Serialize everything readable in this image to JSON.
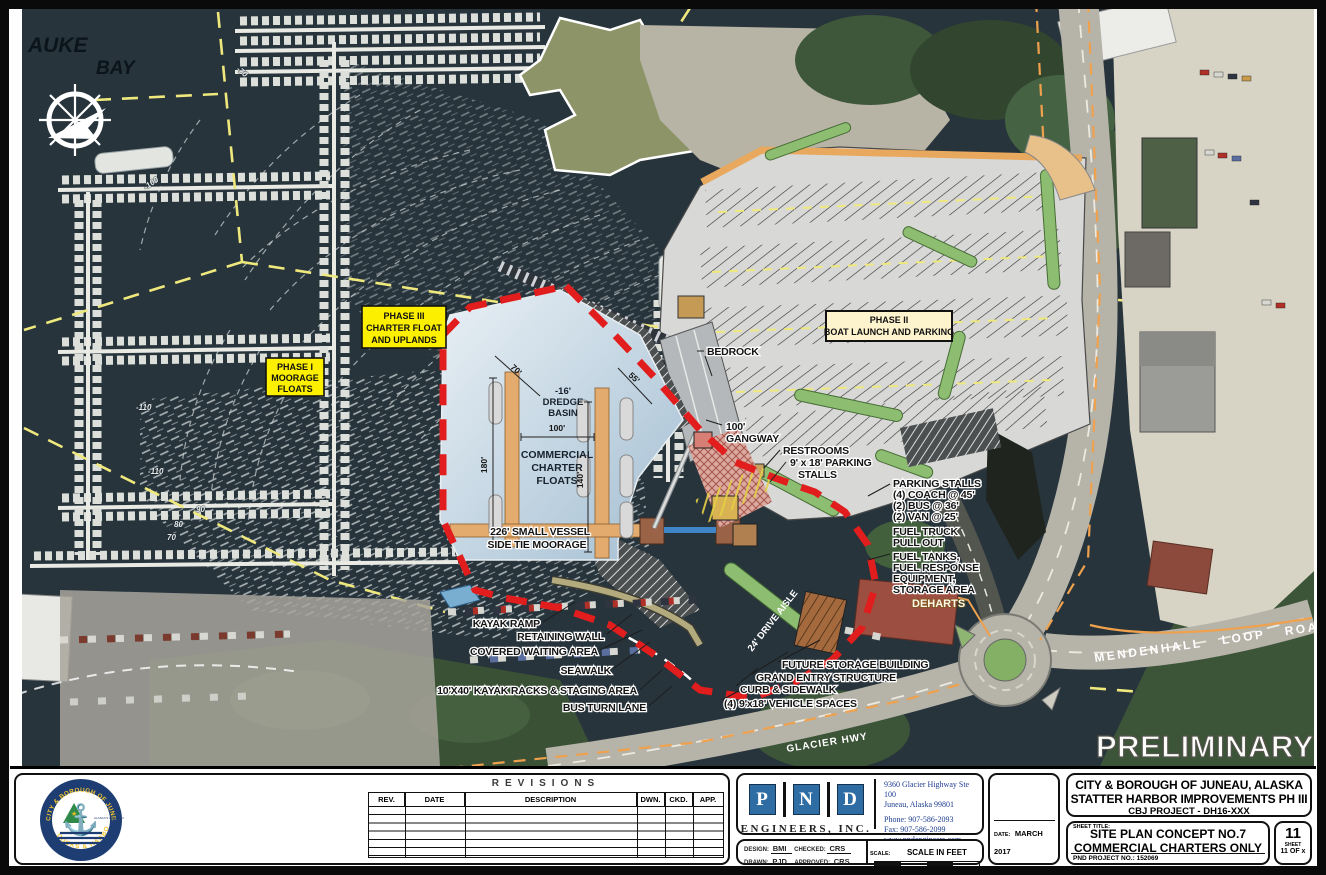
{
  "map": {
    "auke": "AUKE",
    "bay": "BAY",
    "contours": [
      "-70",
      "-100",
      "-110",
      "-110",
      "90",
      "80",
      "70"
    ],
    "phase1": [
      "PHASE I",
      "MOORAGE",
      "FLOATS"
    ],
    "phase3": [
      "PHASE III",
      "CHARTER FLOAT",
      "AND UPLANDS"
    ],
    "phase2": [
      "PHASE II",
      "BOAT LAUNCH AND PARKING"
    ],
    "dredge": [
      "-16'",
      "DREDGE",
      "BASIN"
    ],
    "charter": [
      "COMMERCIAL",
      "CHARTER",
      "FLOATS"
    ],
    "vessel": [
      "226' SMALL VESSEL",
      "SIDE TIE MOORAGE"
    ],
    "dims": {
      "d70": "70'",
      "d55": "55'",
      "d100": "100'",
      "d180": "180'",
      "d140": "140'"
    },
    "bedrock": "BEDROCK",
    "gangway": [
      "100'",
      "GANGWAY"
    ],
    "restrooms": "RESTROOMS",
    "stalls918": [
      "9' x 18' PARKING",
      "STALLS"
    ],
    "parkingList": [
      "PARKING STALLS",
      "(4) COACH @ 45'",
      "(2) BUS @ 36'",
      "(2) VAN @ 25'",
      "FUEL TRUCK",
      "PULL OUT",
      "FUEL TANKS,",
      "FUEL RESPONSE",
      "EQUIPMENT,",
      "STORAGE AREA"
    ],
    "kayakRamp": "KAYAK RAMP",
    "retainingWall": "RETAINING WALL",
    "coveredWaiting": "COVERED WAITING AREA",
    "seawalk": "SEAWALK",
    "kayakRacks": "10'X40' KAYAK RACKS & STAGING AREA",
    "busTurn": "BUS TURN LANE",
    "futureStorage": "FUTURE STORAGE BUILDING",
    "grandEntry": "GRAND ENTRY STRUCTURE",
    "curbSidewalk": "CURB & SIDEWALK",
    "vehicleSpaces": "(4) 9'x18' VEHICLE SPACES",
    "driveAisle": "24' DRIVE AISLE",
    "deharts": "DEHARTS",
    "glacierHwy": "GLACIER HWY",
    "mendenhall": "MENDENHALL LOOP ROAD",
    "preliminary": "PRELIMINARY"
  },
  "titleblock": {
    "revisions": {
      "title": "REVISIONS",
      "cols": [
        "REV.",
        "DATE",
        "DESCRIPTION",
        "DWN.",
        "CKD.",
        "APP."
      ]
    },
    "logo": {
      "top": "CITY & BOROUGH OF JUNEAU",
      "bottom": "DOCKS & HARBORS",
      "inner": "ALASKA'S CAPITAL CITY"
    },
    "pnd": {
      "letters": [
        "P",
        "N",
        "D"
      ],
      "firm": "ENGINEERS, INC.",
      "address": [
        "9360 Glacier Highway Ste 100",
        "Juneau, Alaska 99801"
      ],
      "contact": [
        "Phone: 907-586-2093",
        "Fax: 907-586-2099",
        "www.pndengineers.com"
      ]
    },
    "sign": {
      "design_label": "DESIGN:",
      "design": "BMI",
      "checked_label": "CHECKED:",
      "checked": "CRS",
      "drawn_label": "DRAWN:",
      "drawn": "PJD",
      "approved_label": "APPROVED:",
      "approved": "CRS"
    },
    "scale": {
      "label": "SCALE:",
      "title": "SCALE IN FEET",
      "t0": "0",
      "t60": "60",
      "t120": "120 FT."
    },
    "date": {
      "label": "DATE:",
      "value": "MARCH 2017"
    },
    "project": [
      "CITY & BOROUGH OF JUNEAU, ALASKA",
      "STATTER HARBOR IMPROVEMENTS PH III",
      "CBJ PROJECT - DH16-XXX"
    ],
    "sheet": {
      "label": "SHEET TITLE:",
      "title1": "SITE PLAN CONCEPT NO.7",
      "title2": "COMMERCIAL CHARTERS ONLY",
      "projno_label": "PND PROJECT NO.:",
      "projno": "152069",
      "number": "11",
      "sheet_word": "SHEET",
      "of": "11 OF x"
    }
  }
}
